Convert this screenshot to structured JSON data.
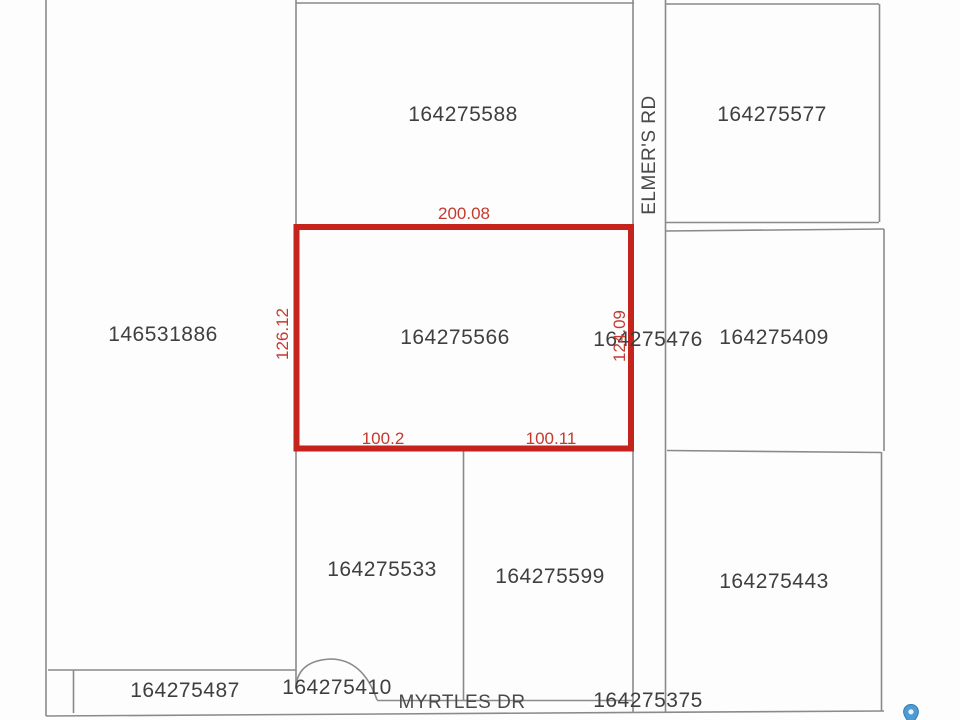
{
  "map": {
    "parcels": {
      "p146531886": {
        "label": "146531886"
      },
      "p164275588": {
        "label": "164275588"
      },
      "p164275577": {
        "label": "164275577"
      },
      "p164275566": {
        "label": "164275566"
      },
      "p164275476": {
        "label": "164275476"
      },
      "p164275409": {
        "label": "164275409"
      },
      "p164275533": {
        "label": "164275533"
      },
      "p164275599": {
        "label": "164275599"
      },
      "p164275443": {
        "label": "164275443"
      },
      "p164275487": {
        "label": "164275487"
      },
      "p164275410": {
        "label": "164275410"
      },
      "p164275375": {
        "label": "164275375"
      }
    },
    "selected_parcel": {
      "label": "164275566",
      "dimensions": {
        "top": "200.08",
        "left": "126.12",
        "right": "124.09",
        "bottom_left": "100.2",
        "bottom_right": "100.11"
      }
    },
    "roads": {
      "elmers_rd": "ELMER'S RD",
      "myrtles_dr": "MYRTLES DR"
    },
    "colors": {
      "highlight_red": "#c4241b",
      "dimension_text_red": "#c43a2e",
      "boundary_gray": "#8a8a8a",
      "parcel_text": "#3f3f3f",
      "marker_blue": "#4f9bd2"
    },
    "icons": {
      "marker": "map-pin"
    }
  }
}
